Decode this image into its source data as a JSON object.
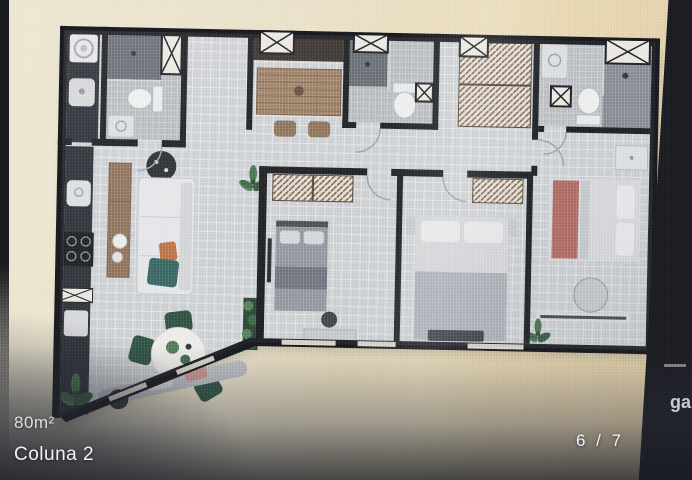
{
  "overlay": {
    "area_label": "80m²",
    "variant_label": "Coluna 2",
    "pagination": "6 / 7",
    "right_edge_partial_text": "ga"
  },
  "floor_plan": {
    "type": "apartment-floor-plan-top-view",
    "total_area": "80m²",
    "rooms": [
      "laundry",
      "bathroom-social",
      "entry-hall",
      "kitchen",
      "bathroom-middle",
      "closet-corridor",
      "bathroom-ensuite",
      "living-dining",
      "bedroom-1",
      "bedroom-2",
      "bedroom-master",
      "angled-balcony-wall"
    ],
    "fixtures": [
      "washing-machine",
      "laundry-tank",
      "toilet-x3",
      "shower-x3",
      "vent-shaft-x",
      "kitchen-island",
      "stools-x2",
      "cooktop",
      "sink",
      "sofa",
      "tv-console",
      "round-dining-table",
      "dining-chairs",
      "beds-x3",
      "wardrobes",
      "round-pouf",
      "bench",
      "plants"
    ]
  },
  "colors": {
    "background_paper": "#e9e0c6",
    "background_warm": "#dcc79c",
    "wall": "#16171b",
    "floor": "#ced1d4",
    "wet_floor": "#b4b8bc",
    "shower_floor": "#60656c",
    "wood": "#9c7b5f",
    "wood_dark": "#352c25",
    "counter_dark": "#26292f",
    "plant_green": "#3c6b45",
    "accent_orange": "#c06a3c",
    "accent_teal": "#2f5f59",
    "accent_red": "#b4625a",
    "bed_gray": "#8e949c",
    "linen": "#e4e5e7",
    "overlay_text": "#f1f2f4"
  }
}
